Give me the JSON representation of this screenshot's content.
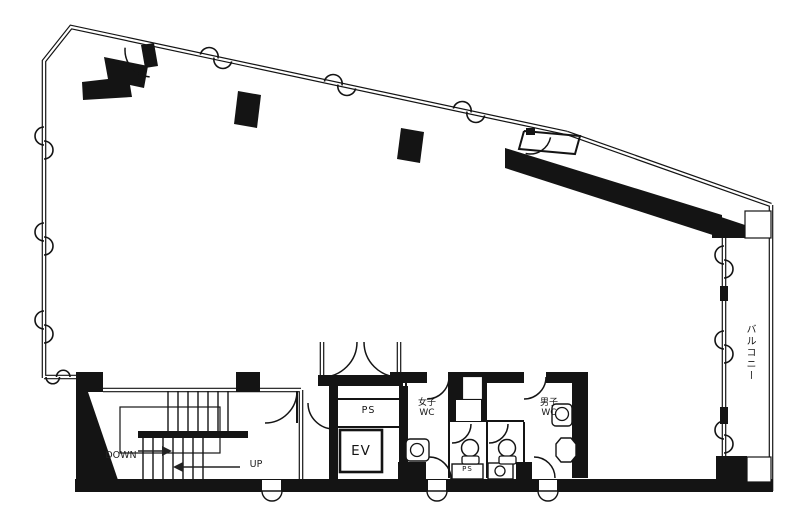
{
  "floor_plan": {
    "rooms": {
      "stairwell": {
        "down_label": "DOWN",
        "up_label": "UP"
      },
      "elevator": {
        "label": "EV"
      },
      "pipe_space_upper": {
        "label": "PS"
      },
      "pipe_space_lower": {
        "label": "PS"
      },
      "womens_wc": {
        "line1": "女子",
        "line2": "WC"
      },
      "mens_wc": {
        "line1": "男子",
        "line2": "WC"
      },
      "balcony": {
        "label": "バルコニー"
      }
    },
    "colors": {
      "ink": "#141414",
      "background": "#ffffff"
    }
  }
}
